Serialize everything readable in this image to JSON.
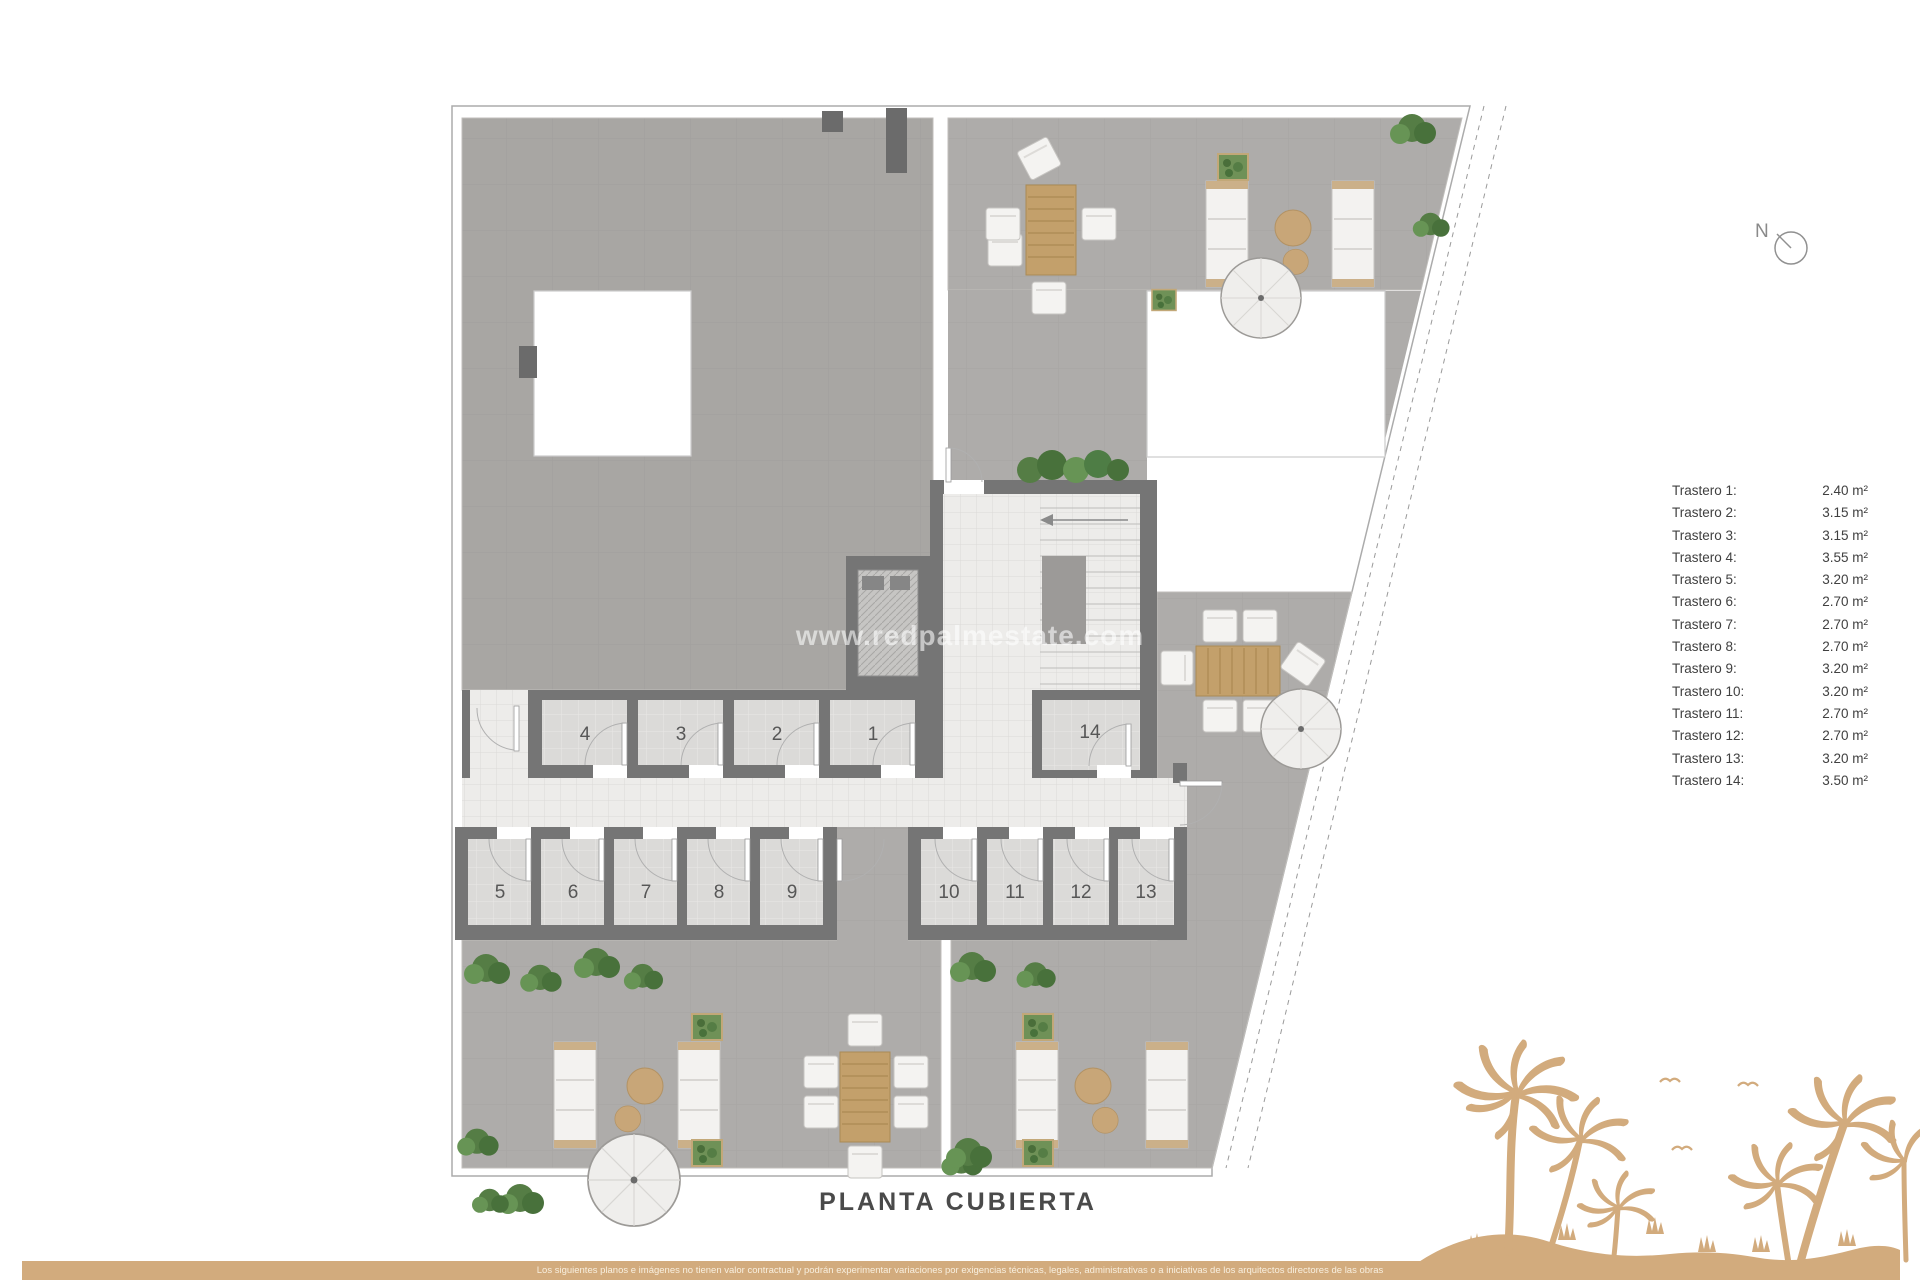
{
  "title": "PLANTA CUBIERTA",
  "watermark": "www.redpalmestate.com",
  "compass": {
    "label": "N"
  },
  "rooms": [
    {
      "number": "1"
    },
    {
      "number": "2"
    },
    {
      "number": "3"
    },
    {
      "number": "4"
    },
    {
      "number": "5"
    },
    {
      "number": "6"
    },
    {
      "number": "7"
    },
    {
      "number": "8"
    },
    {
      "number": "9"
    },
    {
      "number": "10"
    },
    {
      "number": "11"
    },
    {
      "number": "12"
    },
    {
      "number": "13"
    },
    {
      "number": "14"
    }
  ],
  "legend": {
    "items": [
      {
        "label": "Trastero 1:",
        "area": "2.40 m²"
      },
      {
        "label": "Trastero 2:",
        "area": "3.15 m²"
      },
      {
        "label": "Trastero 3:",
        "area": "3.15 m²"
      },
      {
        "label": "Trastero 4:",
        "area": "3.55 m²"
      },
      {
        "label": "Trastero 5:",
        "area": "3.20 m²"
      },
      {
        "label": "Trastero 6:",
        "area": "2.70 m²"
      },
      {
        "label": "Trastero 7:",
        "area": "2.70 m²"
      },
      {
        "label": "Trastero 8:",
        "area": "2.70 m²"
      },
      {
        "label": "Trastero 9:",
        "area": "3.20 m²"
      },
      {
        "label": "Trastero 10:",
        "area": "3.20 m²"
      },
      {
        "label": "Trastero 11:",
        "area": "2.70 m²"
      },
      {
        "label": "Trastero 12:",
        "area": "2.70 m²"
      },
      {
        "label": "Trastero 13:",
        "area": "3.20 m²"
      },
      {
        "label": "Trastero 14:",
        "area": "3.50 m²"
      }
    ]
  },
  "footer": {
    "disclaimer": "Los siguientes planos e imágenes no tienen valor contractual y podrán experimentar variaciones por exigencias técnicas, legales, administrativas o a iniciativas de los arquitectos directores de las obras"
  },
  "colors": {
    "sand": "#d2ab7d",
    "wall": "#757575",
    "roof_tile": "#a8a6a3",
    "terrace_tile": "#aeacaa",
    "plant_green": "#4e7d45"
  }
}
